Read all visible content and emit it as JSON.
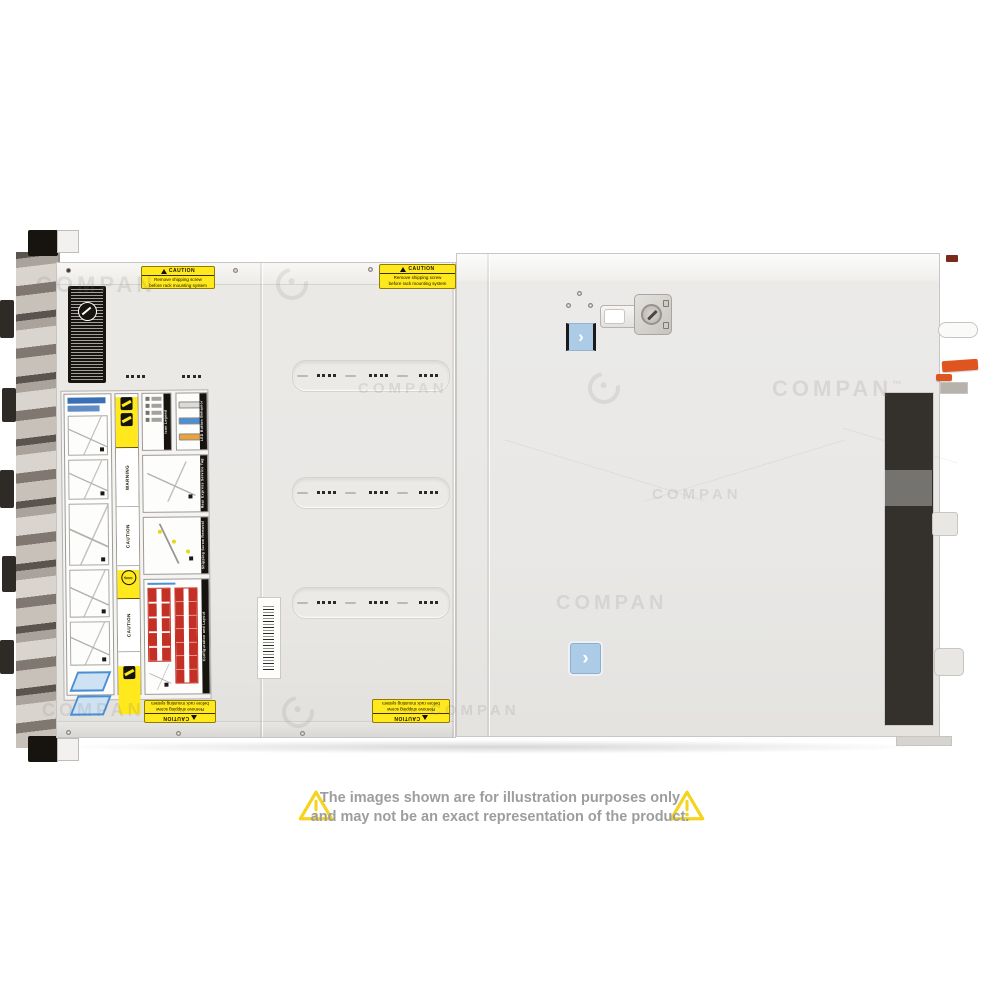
{
  "page": {
    "background_color": "#ffffff"
  },
  "watermark": {
    "text": "COMPAN",
    "tm_text": "™"
  },
  "server_photo": {
    "description": "rack server chassis, top view",
    "shipping_caution_sticker": {
      "header": "CAUTION",
      "line1": "Remove shipping screw",
      "line2": "before rack mounting system"
    },
    "service_label": {
      "sections": [
        {
          "title": "Icon Legend"
        },
        {
          "title": "LED Button Behavior"
        },
        {
          "title": "Rear Express Service Tag"
        },
        {
          "title": "Shipping Screw Removal"
        },
        {
          "title": "Configuration and Layout"
        }
      ],
      "warning_text": "WARNING",
      "caution_text": "CAUTION",
      "screw_size_text": "5mm",
      "led_bar_colors": [
        "#dcdad6",
        "#4a90d9",
        "#e8a33d"
      ],
      "drive_grid_color": "#c43025"
    },
    "chevron_glyph": "›",
    "latch_button_color": "#a9c9e8",
    "caution_yellow": "#ffe81c",
    "handle_orange": "#e0551f"
  },
  "disclaimer": {
    "line1": "The images shown are for illustration purposes only",
    "line2": "and may not be an exact representation of the product."
  }
}
